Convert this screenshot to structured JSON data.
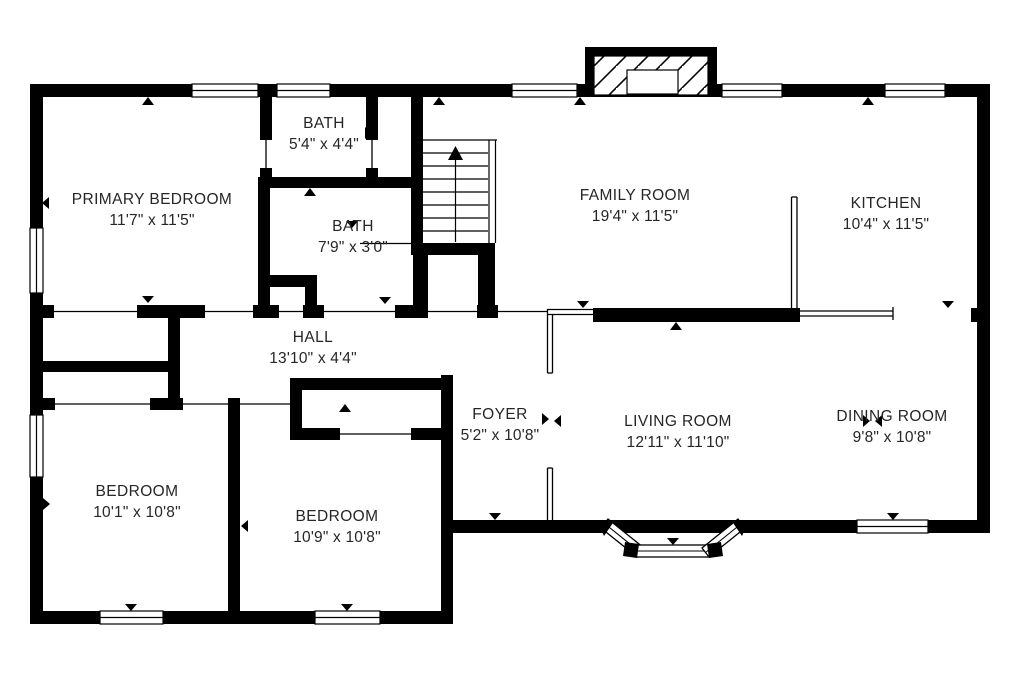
{
  "page": {
    "background": "#ffffff",
    "ink": "#000000"
  },
  "floorplan": {
    "rooms": [
      {
        "id": "primary-bedroom",
        "name": "PRIMARY BEDROOM",
        "dims": "11'7\" x 11'5\""
      },
      {
        "id": "bath-upper",
        "name": "BATH",
        "dims": "5'4\" x 4'4\""
      },
      {
        "id": "bath-lower",
        "name": "BATH",
        "dims": "7'9\" x 3'0\""
      },
      {
        "id": "family-room",
        "name": "FAMILY ROOM",
        "dims": "19'4\" x 11'5\""
      },
      {
        "id": "kitchen",
        "name": "KITCHEN",
        "dims": "10'4\" x 11'5\""
      },
      {
        "id": "hall",
        "name": "HALL",
        "dims": "13'10\" x 4'4\""
      },
      {
        "id": "foyer",
        "name": "FOYER",
        "dims": "5'2\" x 10'8\""
      },
      {
        "id": "living-room",
        "name": "LIVING ROOM",
        "dims": "12'11\" x 11'10\""
      },
      {
        "id": "dining-room",
        "name": "DINING ROOM",
        "dims": "9'8\" x 10'8\""
      },
      {
        "id": "bedroom-left",
        "name": "BEDROOM",
        "dims": "10'1\" x 10'8\""
      },
      {
        "id": "bedroom-middle",
        "name": "BEDROOM",
        "dims": "10'9\" x 10'8\""
      }
    ],
    "features": {
      "staircase": {
        "icon": "stair-up-arrow",
        "direction": "up"
      },
      "fireplace": {
        "icon": "fireplace-hatch"
      },
      "bay_window": {
        "icon": "bay-window"
      },
      "door_marker": {
        "icon": "door-marker-triangle"
      },
      "window": {
        "icon": "window-double-line"
      }
    }
  }
}
